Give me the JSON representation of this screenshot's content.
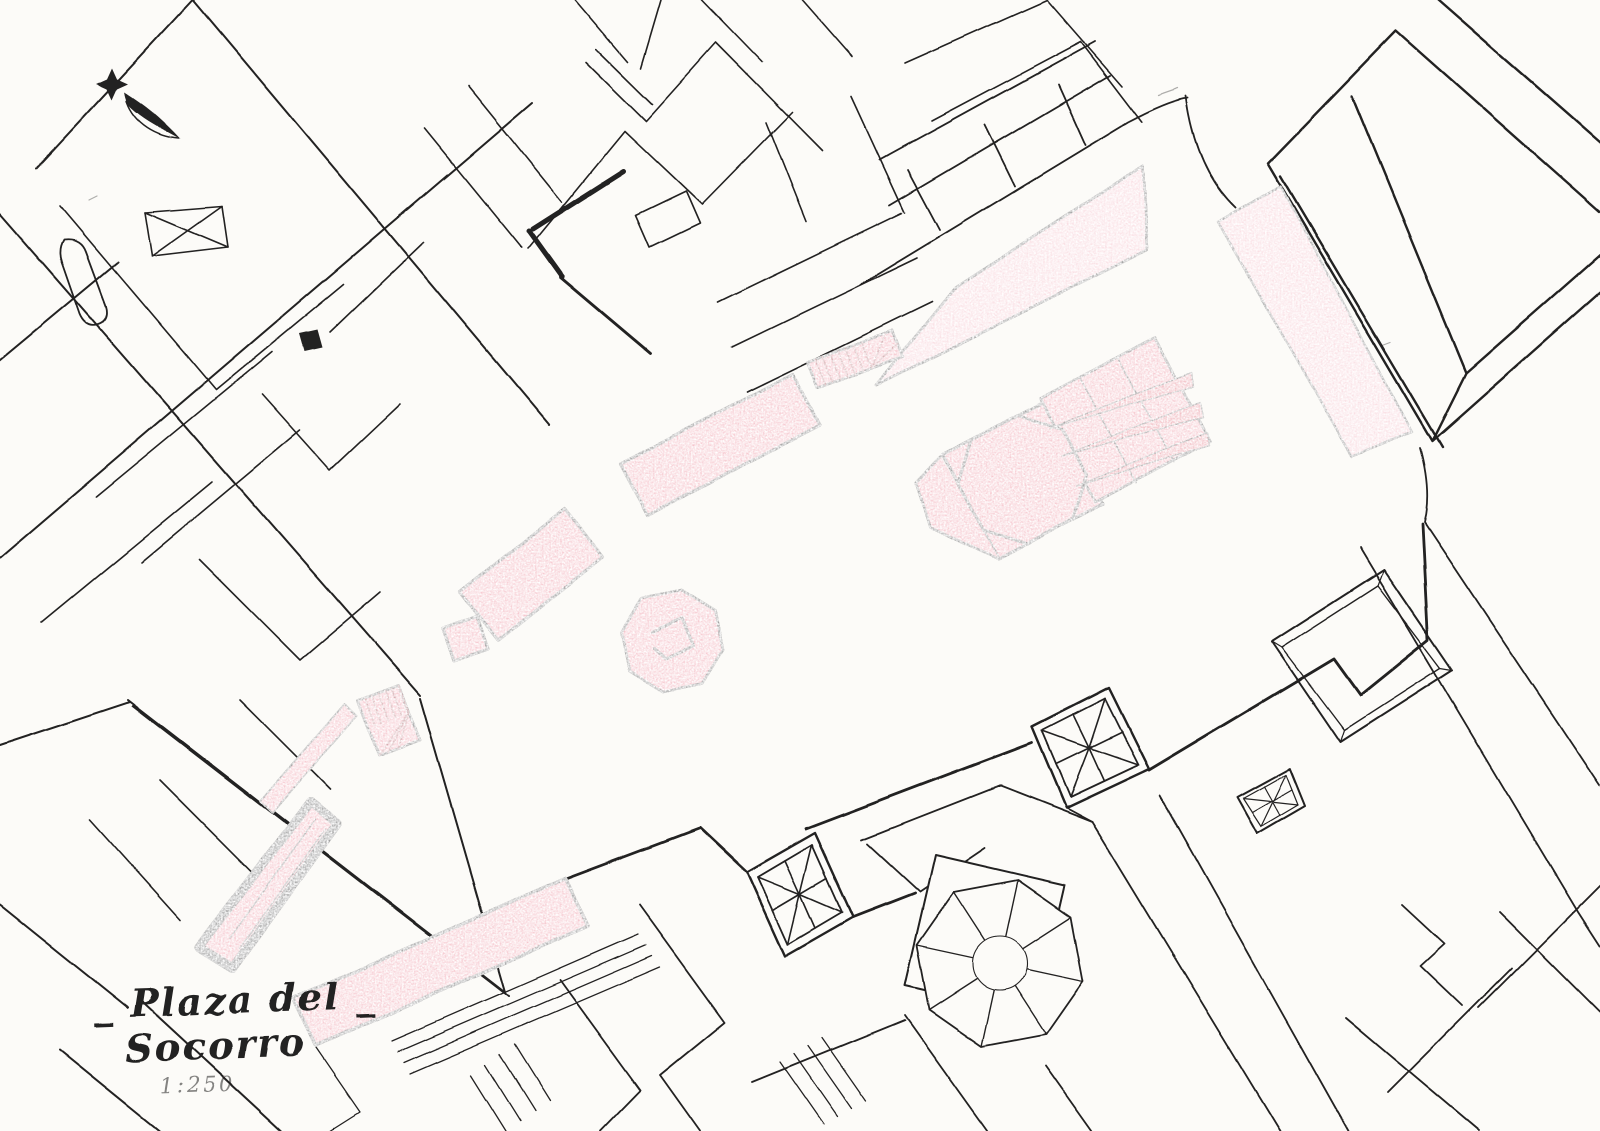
{
  "document": {
    "title_line1": "_ Plaza del _",
    "title_line2": "Socorro",
    "scale_label": "1:250"
  },
  "colors": {
    "paper": "#fcfbf8",
    "ink": "#232020",
    "pink_light": "#f7cbd3",
    "pink": "#f2a3b0",
    "pink_strong": "#ea8191",
    "red_accent": "#b03a4a"
  },
  "icons": {
    "north_arrow": "north-arrow"
  }
}
